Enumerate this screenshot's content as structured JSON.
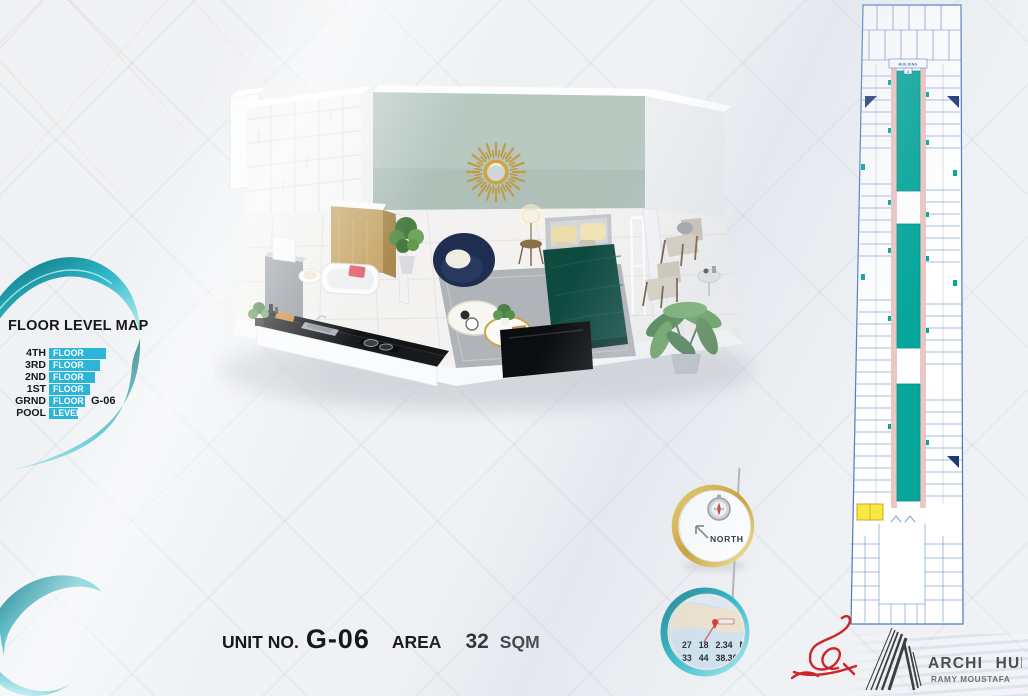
{
  "page": {
    "title": "Unit G-06 Floor Plan Presentation"
  },
  "colors": {
    "accent_cyan": "#2bb6d9",
    "swirl_teal": "#18b2c2",
    "gold": "#cfa43a",
    "plan_teal": "#06a69b",
    "plan_pink": "#eac7c3",
    "plan_blue": "#4c79c4",
    "highlight_yellow": "#f6e93f",
    "sage": "#b7c8c1",
    "bed_teal": "#0e4a40",
    "navy": "#1e2d50",
    "signature_red": "#cd2428",
    "text_dark": "#17181c"
  },
  "floor_level_map": {
    "title": "FLOOR LEVEL MAP",
    "rows": [
      {
        "label": "4TH",
        "bar": "FLOOR",
        "suffix": ""
      },
      {
        "label": "3RD",
        "bar": "FLOOR",
        "suffix": ""
      },
      {
        "label": "2ND",
        "bar": "FLOOR",
        "suffix": ""
      },
      {
        "label": "1ST",
        "bar": "FLOOR",
        "suffix": ""
      },
      {
        "label": "GRND",
        "bar": "FLOOR",
        "suffix": "G-06"
      },
      {
        "label": "POOL",
        "bar": "LEVEL",
        "suffix": ""
      }
    ]
  },
  "unit_caption": {
    "unit_label": "UNIT NO.",
    "unit_number": "G-06",
    "area_label": "AREA",
    "area_value": "32",
    "area_unit": "SQM"
  },
  "compass": {
    "label": "NORTH"
  },
  "location": {
    "latitude": "27 18 2.34 N",
    "longitude": "33 44 38.36 E"
  },
  "site_plan": {
    "building_label": "BUILDING",
    "building_number": "2"
  },
  "branding": {
    "studio": "ARCHI HUB",
    "author": "RAMY MOUSTAFA"
  }
}
